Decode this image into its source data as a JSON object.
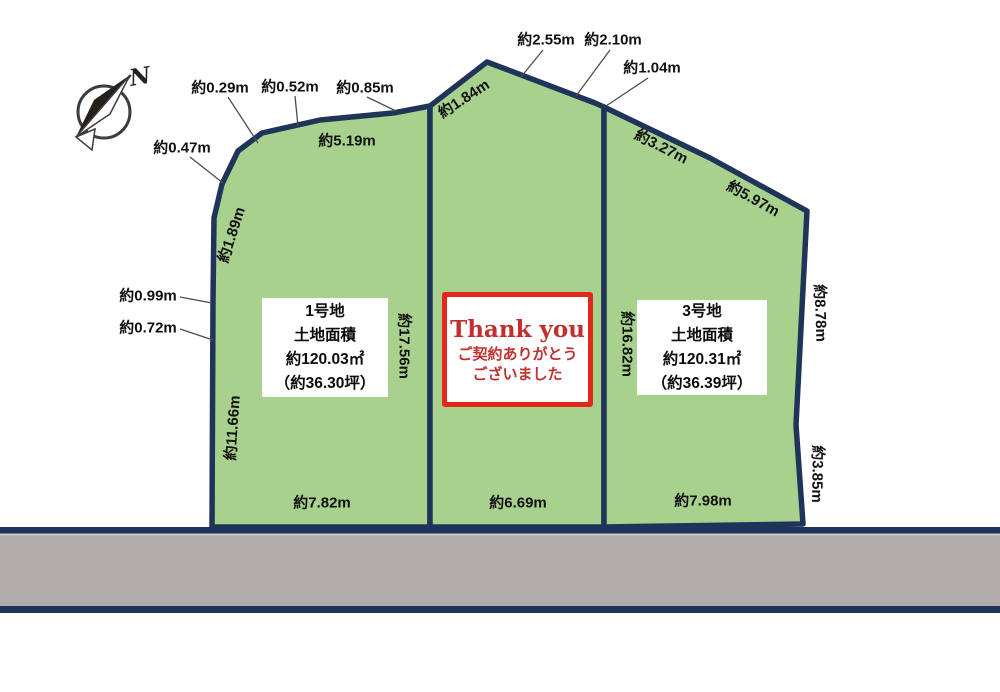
{
  "compass": {
    "north_label": "N"
  },
  "plots": {
    "plot1": {
      "name": "1号地",
      "area_title": "土地面積",
      "area": "約120.03㎡",
      "tsubo": "（約36.30坪）"
    },
    "plot3": {
      "name": "3号地",
      "area_title": "土地面積",
      "area": "約120.31㎡",
      "tsubo": "（約36.39坪）"
    }
  },
  "sold_box": {
    "title": "Thank you",
    "line1": "ご契約ありがとう",
    "line2": "ございました"
  },
  "measurements": {
    "top1": "約0.29m",
    "top2": "約0.52m",
    "top3": "約0.85m",
    "left_diag": "約0.47m",
    "top_long": "約5.19m",
    "apex_right1": "約2.55m",
    "apex_right2": "約2.10m",
    "apex_right3": "約1.04m",
    "apex_left": "約1.84m",
    "p3_top1": "約3.27m",
    "p3_top2": "約5.97m",
    "left_upper": "約1.89m",
    "left_mid1": "約0.99m",
    "left_mid2": "約0.72m",
    "left_lower": "約11.66m",
    "p1_right": "約17.56m",
    "p3_left": "約16.82m",
    "right_upper": "約8.78m",
    "right_lower": "約3.85m",
    "p1_bottom": "約7.82m",
    "p2_bottom": "約6.69m",
    "p3_bottom": "約7.98m"
  },
  "colors": {
    "plot_fill": "#a9d18e",
    "boundary_navy": "#20345a",
    "road_gray": "#b1abab",
    "sold_border_red": "#e3271b",
    "sold_text_red": "#c22f2f"
  }
}
